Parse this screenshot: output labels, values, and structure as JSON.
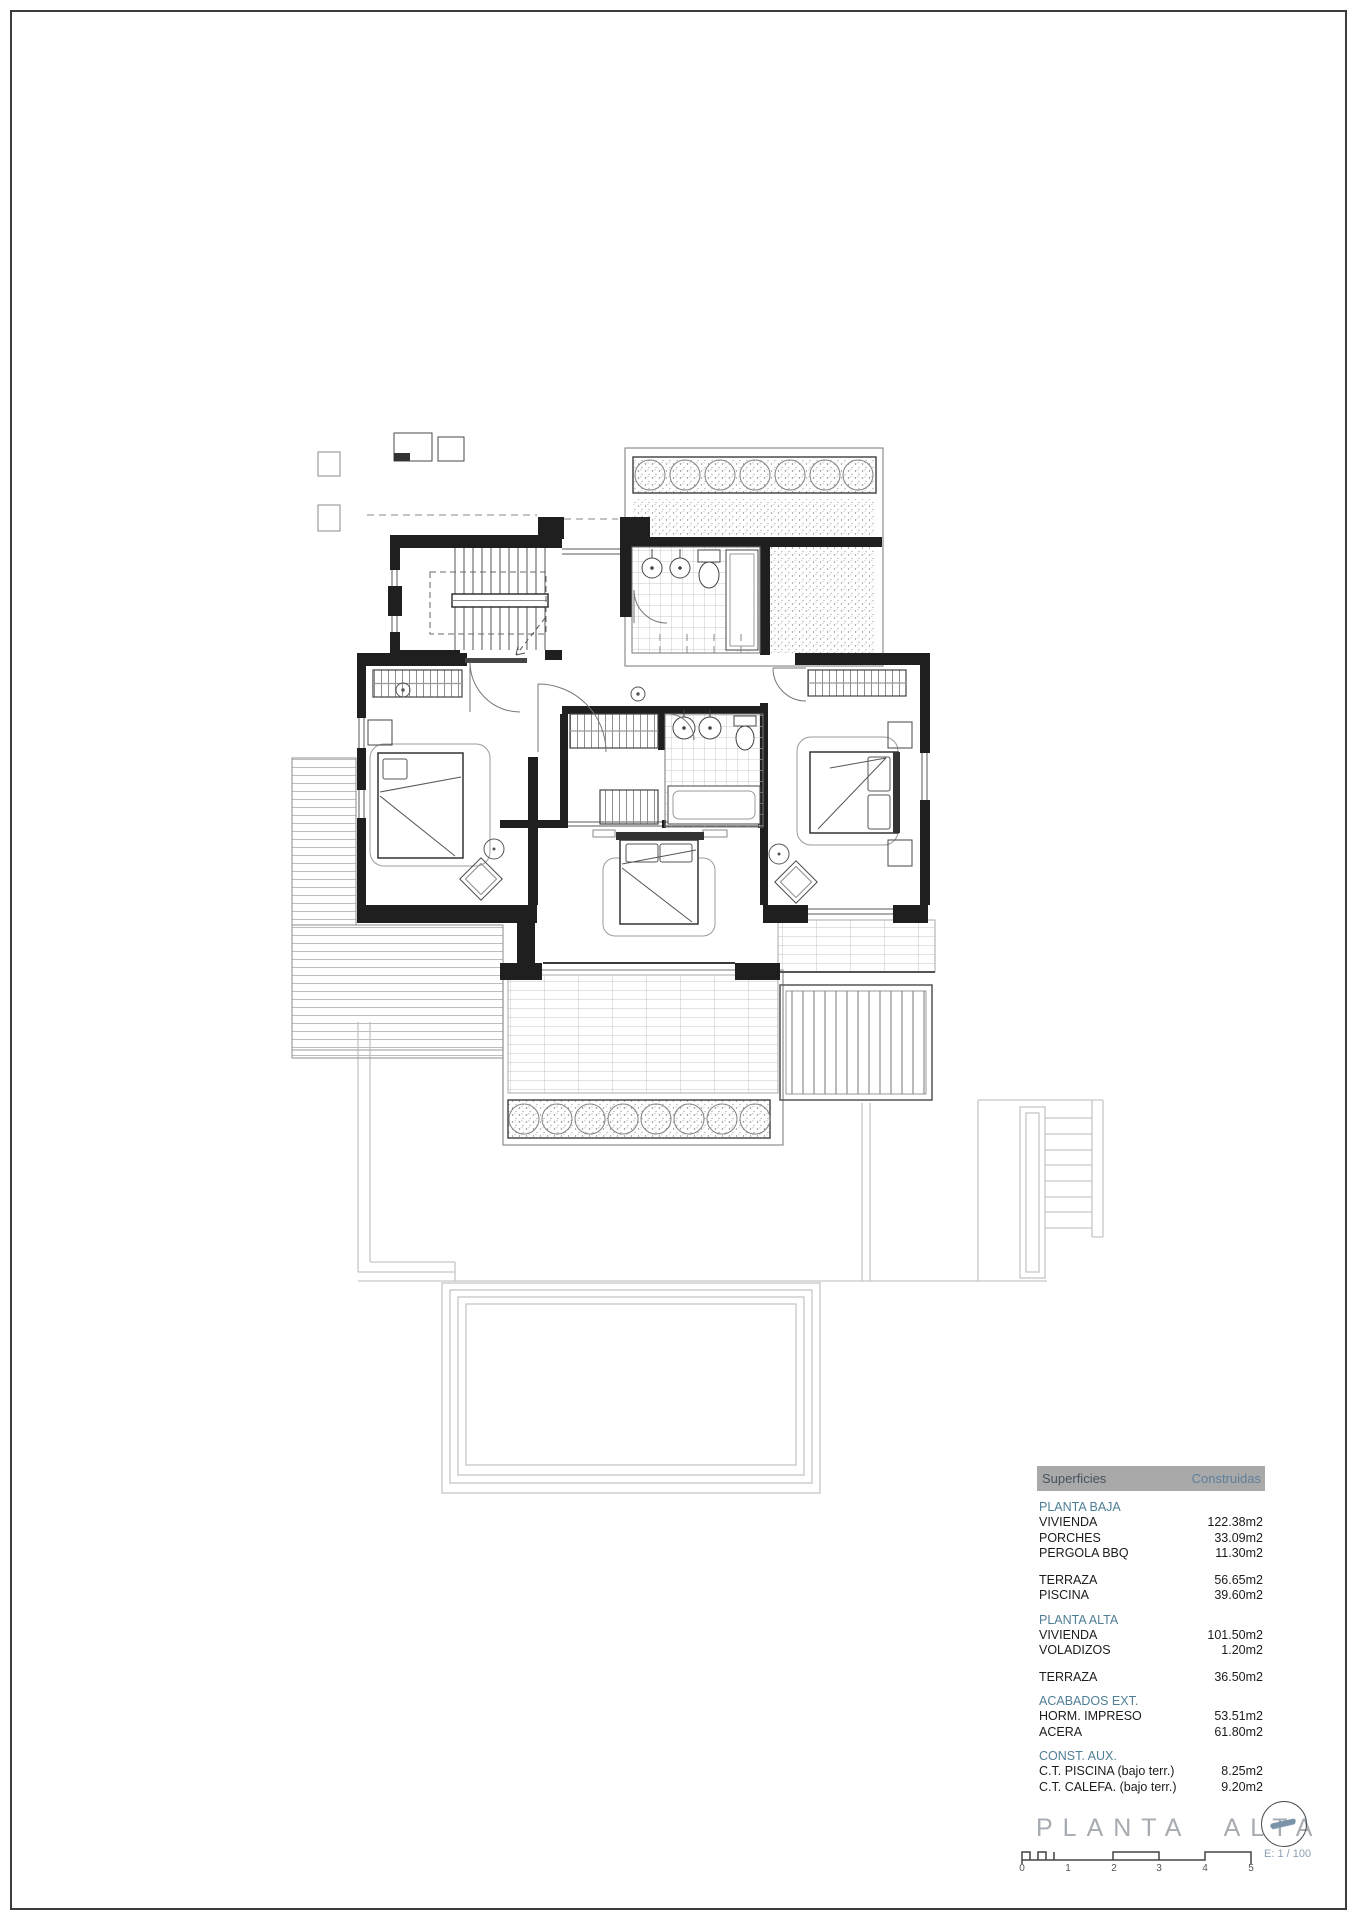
{
  "plan": {
    "title": "PLANTA ALTA",
    "scale_label": "E: 1 / 100"
  },
  "scale_ticks": [
    "0",
    "1",
    "2",
    "3",
    "4",
    "5"
  ],
  "areas_table": {
    "header": {
      "col1": "Superficies",
      "col2": "Construidas"
    },
    "sections": [
      {
        "title": "PLANTA BAJA",
        "rows": [
          {
            "label": "VIVIENDA",
            "value": "122.38m2"
          },
          {
            "label": "PORCHES",
            "value": "33.09m2"
          },
          {
            "label": "PERGOLA BBQ",
            "value": "11.30m2"
          }
        ],
        "rows2": [
          {
            "label": "TERRAZA",
            "value": "56.65m2"
          },
          {
            "label": "PISCINA",
            "value": "39.60m2"
          }
        ]
      },
      {
        "title": "PLANTA ALTA",
        "rows": [
          {
            "label": "VIVIENDA",
            "value": "101.50m2"
          },
          {
            "label": "VOLADIZOS",
            "value": "1.20m2"
          }
        ],
        "rows2": [
          {
            "label": "TERRAZA",
            "value": "36.50m2"
          }
        ]
      },
      {
        "title": "ACABADOS EXT.",
        "rows": [
          {
            "label": "HORM. IMPRESO",
            "value": "53.51m2"
          },
          {
            "label": "ACERA",
            "value": "61.80m2"
          }
        ]
      },
      {
        "title": "CONST. AUX.",
        "rows": [
          {
            "label": "C.T. PISCINA (bajo terr.)",
            "value": "8.25m2"
          },
          {
            "label": "C.T. CALEFA. (bajo terr.)",
            "value": "9.20m2"
          }
        ]
      }
    ]
  },
  "colors": {
    "table_header_bg": "#a9a9a9",
    "table_header_col2": "#5d7f9c",
    "section_title": "#4f7e95",
    "plan_title_gray": "#a6acb1",
    "wall_black": "#1f1f1f",
    "faint_ground_floor": "#b9bec2"
  }
}
